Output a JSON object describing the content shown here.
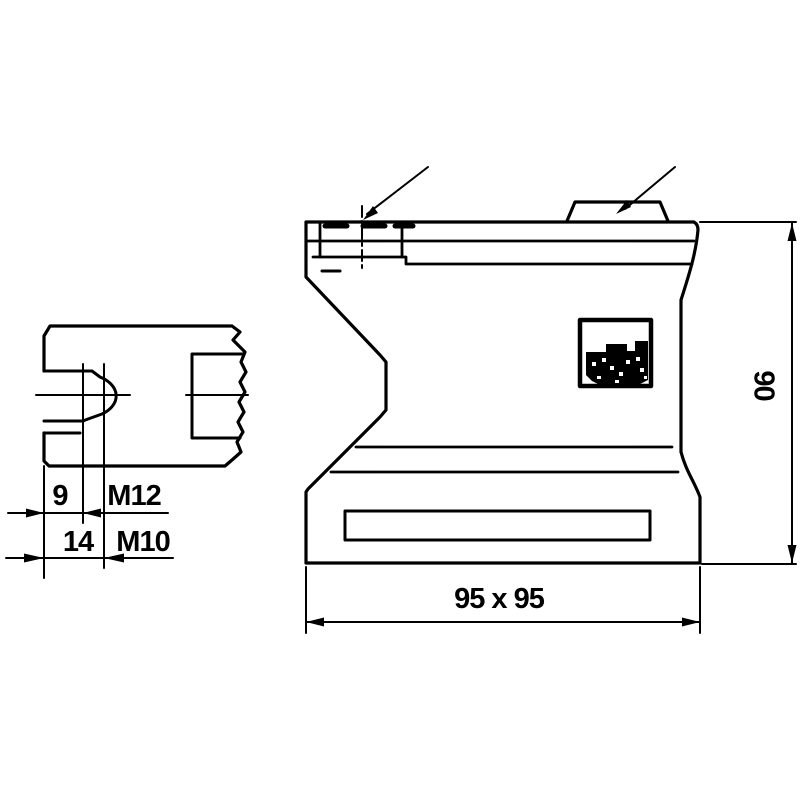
{
  "colors": {
    "ink": "#000000",
    "paper": "#ffffff"
  },
  "views": {
    "side_section": {
      "dims": {
        "step_depth": "9",
        "total_depth": "14"
      },
      "threads": {
        "upper": "M12",
        "lower": "M10"
      }
    },
    "front": {
      "dims": {
        "footprint": "95 x 95",
        "height": "90"
      }
    }
  }
}
